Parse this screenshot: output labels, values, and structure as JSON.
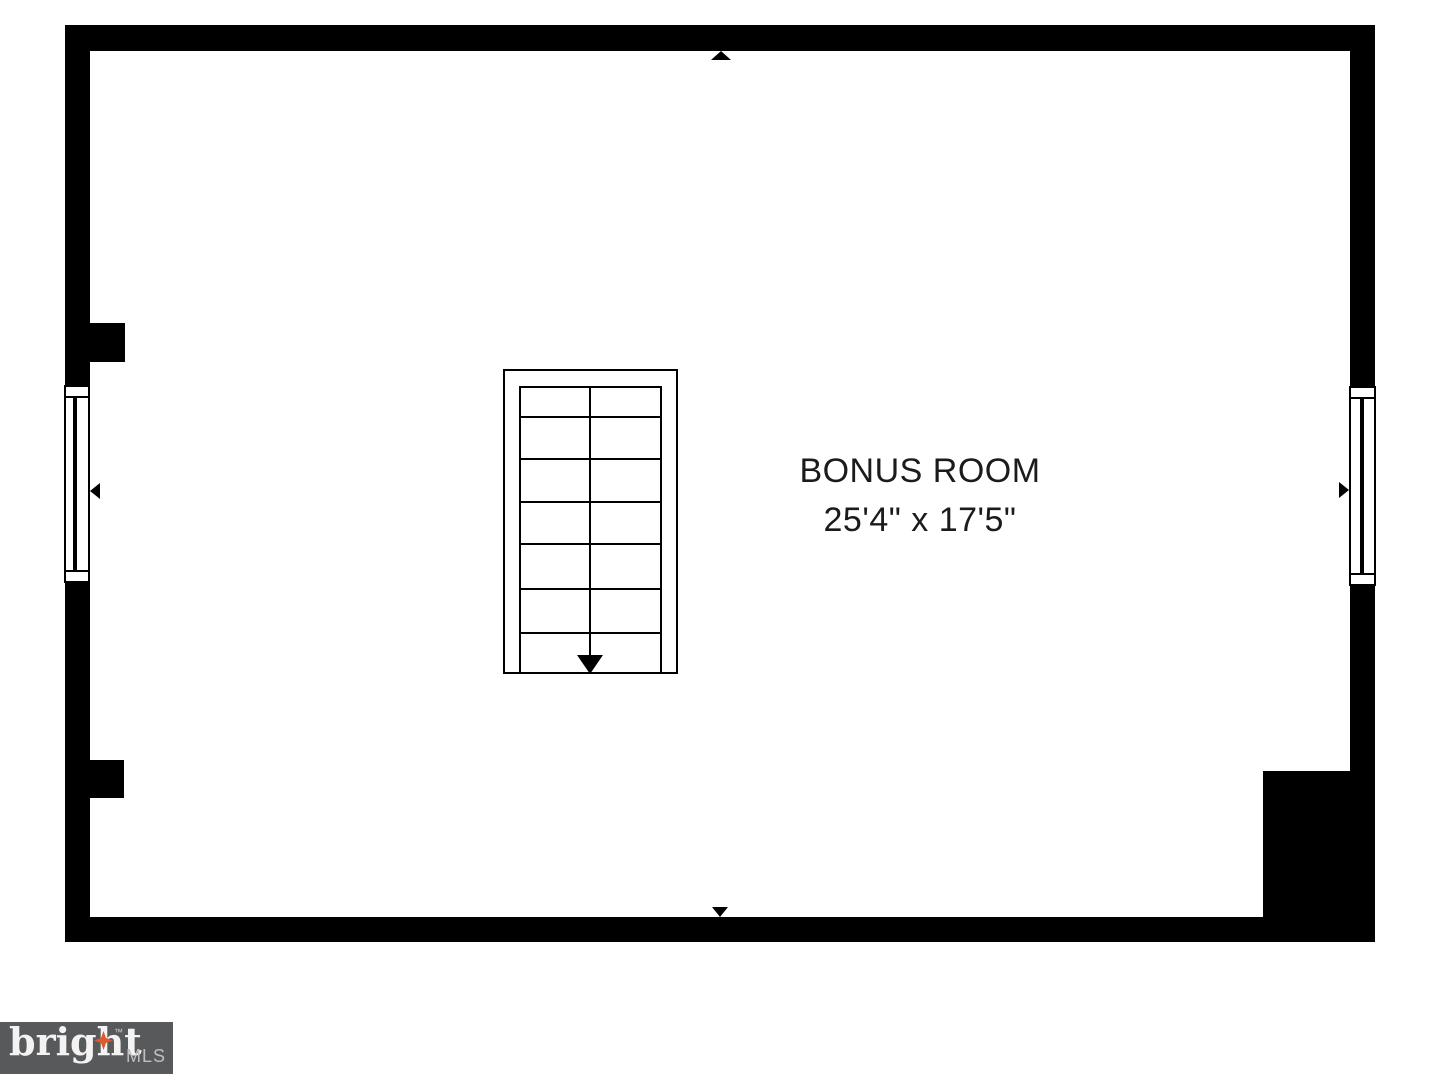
{
  "image": {
    "width": 1440,
    "height": 1080,
    "background": "#ffffff"
  },
  "floor_plan": {
    "room": {
      "name": "BONUS ROOM",
      "dimensions": "25'4\" x 17'5\""
    },
    "stairs": {
      "tread_rows": 7,
      "direction_arrow": "down"
    },
    "compass_arrows": [
      "north",
      "south",
      "west",
      "east"
    ],
    "windows": [
      "left-wall-window",
      "right-wall-window"
    ],
    "wall_color": "#000000"
  },
  "logo": {
    "brand": "bright",
    "suffix": "MLS",
    "trademark": "™",
    "star_icon": "four-point-star",
    "colors": {
      "background": "#58595b",
      "brand": "#f3f3f3",
      "suffix": "#bfc0c2",
      "star": "#dc5a2b"
    }
  }
}
